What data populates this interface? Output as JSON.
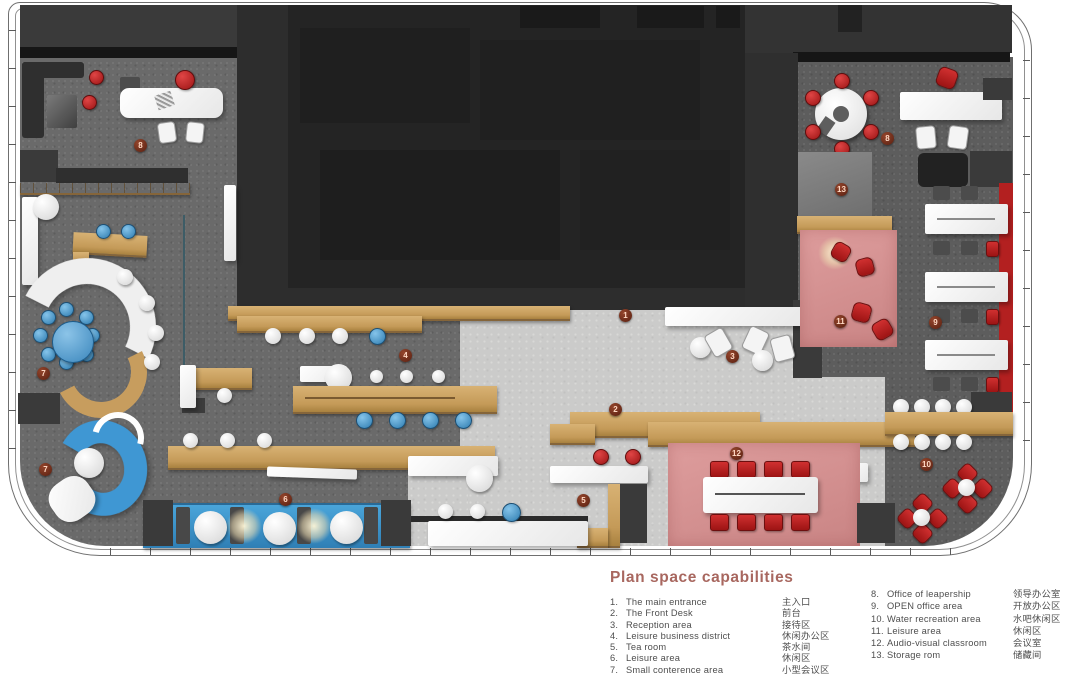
{
  "legend": {
    "title": "Plan space capabilities",
    "left": [
      {
        "num": "1.",
        "en": "The main entrance",
        "zh": "主入口"
      },
      {
        "num": "2.",
        "en": "The Front Desk",
        "zh": "前台"
      },
      {
        "num": "3.",
        "en": "Reception area",
        "zh": "接待区"
      },
      {
        "num": "4.",
        "en": "Leisure business district",
        "zh": "休闲办公区"
      },
      {
        "num": "5.",
        "en": "Tea room",
        "zh": "茶水间"
      },
      {
        "num": "6.",
        "en": "Leisure area",
        "zh": "休闲区"
      },
      {
        "num": "7.",
        "en": "Small conterence area",
        "zh": "小型会议区"
      }
    ],
    "right": [
      {
        "num": "8.",
        "en": "Office of leapership",
        "zh": "领导办公室"
      },
      {
        "num": "9.",
        "en": "OPEN office area",
        "zh": "开放办公区"
      },
      {
        "num": "10.",
        "en": "Water recreation area",
        "zh": "水吧休闲区"
      },
      {
        "num": "11.",
        "en": "Leisure  area",
        "zh": "休闲区"
      },
      {
        "num": "12.",
        "en": "Audio-visual classroom",
        "zh": "会议室"
      },
      {
        "num": "13.",
        "en": "Storage rom",
        "zh": "储藏间"
      }
    ]
  },
  "markers": [
    {
      "n": "1",
      "x": 626,
      "y": 316
    },
    {
      "n": "2",
      "x": 616,
      "y": 410
    },
    {
      "n": "3",
      "x": 733,
      "y": 357
    },
    {
      "n": "4",
      "x": 406,
      "y": 356
    },
    {
      "n": "5",
      "x": 584,
      "y": 501
    },
    {
      "n": "6",
      "x": 286,
      "y": 500
    },
    {
      "n": "7",
      "x": 44,
      "y": 374
    },
    {
      "n": "7",
      "x": 46,
      "y": 470
    },
    {
      "n": "8",
      "x": 141,
      "y": 146
    },
    {
      "n": "8",
      "x": 888,
      "y": 139
    },
    {
      "n": "9",
      "x": 936,
      "y": 323
    },
    {
      "n": "10",
      "x": 927,
      "y": 465
    },
    {
      "n": "11",
      "x": 841,
      "y": 322
    },
    {
      "n": "12",
      "x": 737,
      "y": 454
    },
    {
      "n": "13",
      "x": 842,
      "y": 190
    }
  ],
  "colors": {
    "legend_title": "#a8675f",
    "legend_text": "#4e4e4e",
    "marker": "#6e2a18",
    "wood": "#c49a58",
    "blue_furniture": "#3f97d3",
    "red_furniture": "#b32020",
    "pink_floor": "#d59191",
    "dark_core": "#2d2d2d",
    "floor_dark": "#6a6a6a",
    "floor_light": "#cbcbca"
  }
}
